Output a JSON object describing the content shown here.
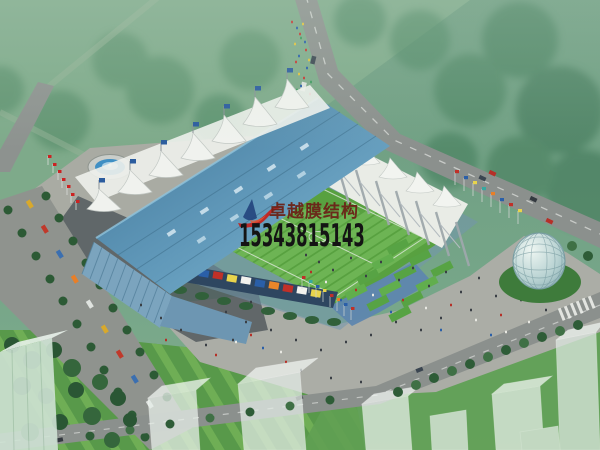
{
  "window": {
    "width": 600,
    "height": 450
  },
  "image_type": "architectural-rendering-aerial-view",
  "subject": "Membrane-structure stadium with tensile tent roofs, football pitch, fountain plaza, tree-lined parking avenue, glass egg pavilion and surrounding roads",
  "watermark": {
    "logo": "red-swoosh-with-blue-sail",
    "company_name": "卓越膜结构",
    "phone_number": "15343815143",
    "company_name_color": "#6b2318",
    "phone_color": "#141414"
  },
  "palette": {
    "background_green": "#72a084",
    "field_green": "#7fab8b",
    "pitch_green": "#58a140",
    "stadium_roof_blue": "#5b93b4",
    "membrane_white": "#f0f2ee",
    "road_gray": "#8b908d",
    "plaza_gray": "#a9aba3",
    "shadow_gray": "#4b5359",
    "water_blue": "#3f8fc4",
    "tree_green": "#2e5c37"
  }
}
